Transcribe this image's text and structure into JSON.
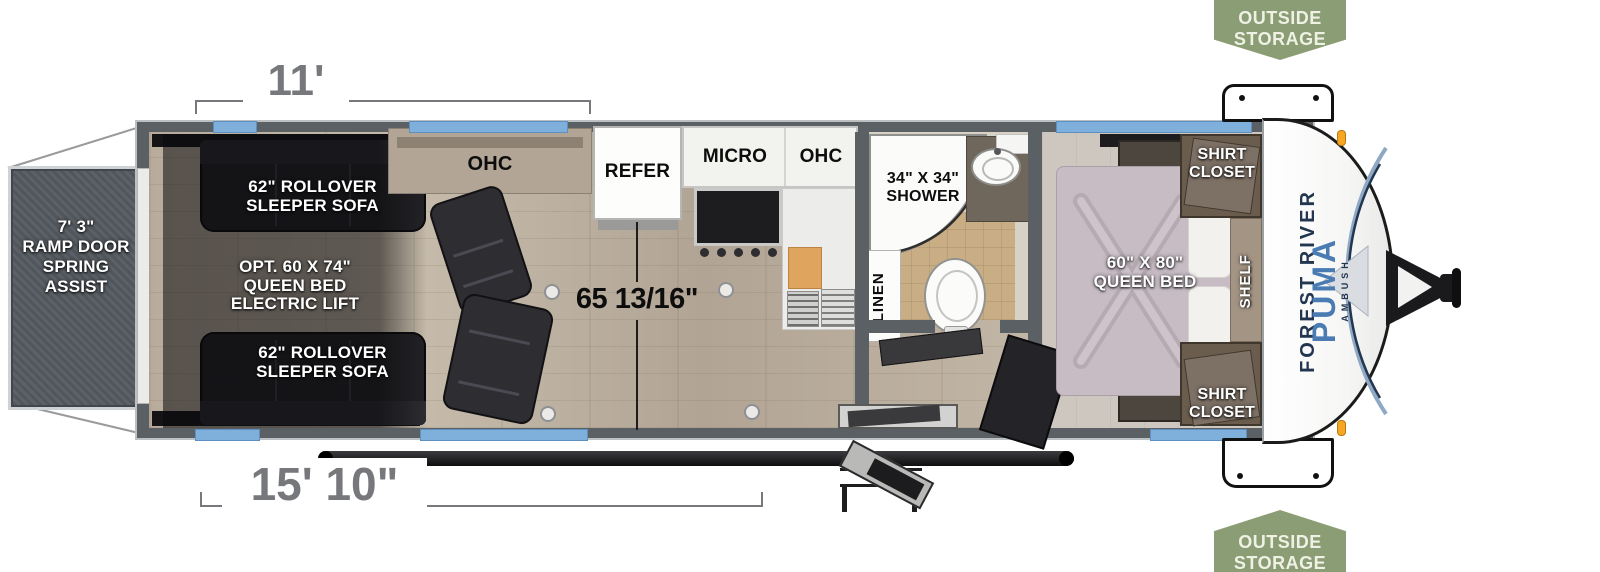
{
  "badges": {
    "top": {
      "line1": "OUTSIDE",
      "line2": "STORAGE"
    },
    "bottom": {
      "line1": "OUTSIDE",
      "line2": "STORAGE"
    }
  },
  "dimensions": {
    "garage_length": "11'",
    "cargo_length": "15' 10\"",
    "garage_height": "65 13/16\""
  },
  "ramp_door": {
    "l1": "7' 3\"",
    "l2": "RAMP DOOR",
    "l3": "SPRING",
    "l4": "ASSIST"
  },
  "garage": {
    "sofa_top_l1": "62\" ROLLOVER",
    "sofa_top_l2": "SLEEPER SOFA",
    "bed_lift_l1": "OPT. 60 X 74\"",
    "bed_lift_l2": "QUEEN BED",
    "bed_lift_l3": "ELECTRIC LIFT",
    "sofa_bottom_l1": "62\" ROLLOVER",
    "sofa_bottom_l2": "SLEEPER SOFA",
    "ohc": "OHC"
  },
  "kitchen": {
    "refer": "REFER",
    "micro": "MICRO",
    "ohc": "OHC"
  },
  "bathroom": {
    "shower_l1": "34\" X 34\"",
    "shower_l2": "SHOWER",
    "linen": "LINEN"
  },
  "bedroom": {
    "bed_l1": "60\" X 80\"",
    "bed_l2": "QUEEN BED",
    "closet_top_l1": "SHIRT",
    "closet_top_l2": "CLOSET",
    "closet_bottom_l1": "SHIRT",
    "closet_bottom_l2": "CLOSET",
    "shelf": "SHELF"
  },
  "brand": {
    "maker": "FOREST RIVER",
    "model": "PUMA",
    "trim": "AMBUSH"
  },
  "colors": {
    "badge_green": "#8b9d74",
    "window_blue": "#7fb0dc",
    "wall_gray": "#5b6064",
    "puma_blue": "#4a7cb3",
    "forest_navy": "#23364f",
    "dimension_gray": "#76787b"
  }
}
